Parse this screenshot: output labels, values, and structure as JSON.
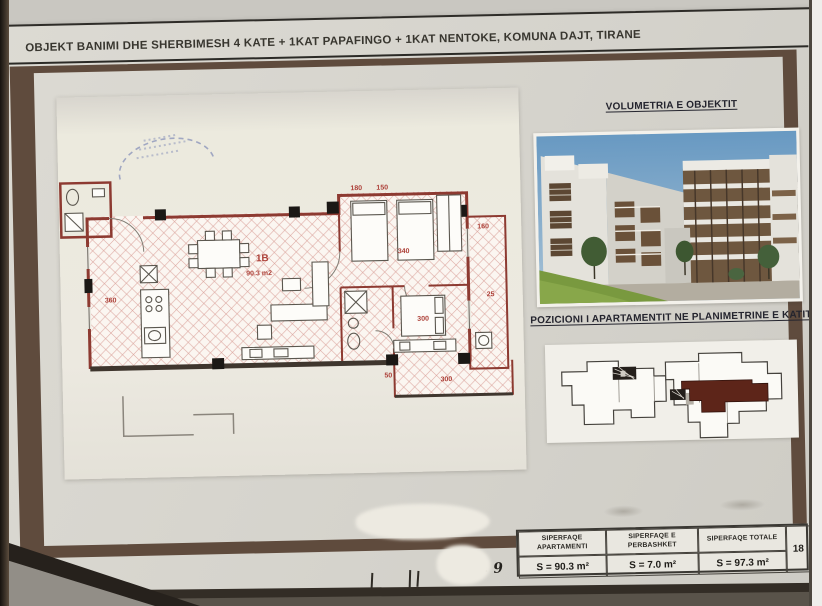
{
  "sheet": {
    "title": "OBJEKT BANIMI DHE SHERBIMESH 4 KATE + 1KAT PAPAFINGO + 1KAT NENTOKE, KOMUNA DAJT, TIRANE"
  },
  "volumetria": {
    "heading": "VOLUMETRIA E OBJEKTIT"
  },
  "pozicioni": {
    "heading": "POZICIONI I APARTAMENTIT NE PLANIMETRINE E KATIT"
  },
  "floor_plan": {
    "unit_label": "1B",
    "unit_area": "90.3 m2",
    "dimensions": [
      "360",
      "180",
      "150",
      "340",
      "160",
      "25",
      "300",
      "50",
      "300"
    ]
  },
  "summary_table": {
    "columns": [
      {
        "header": "SIPERFAQE APARTAMENTI",
        "value": "S = 90.3 m²"
      },
      {
        "header": "SIPERFAQE E PERBASHKET",
        "value": "S = 7.0 m²"
      },
      {
        "header": "SIPERFAQE TOTALE",
        "value": "S = 97.3 m²"
      }
    ],
    "sheet_number": "18"
  },
  "footer": {
    "signature_label": "Z/ZNJ",
    "handwritten_note": "= 9"
  },
  "colors": {
    "wall_red": "#8d3a31",
    "frame_brown": "#5f4b3d",
    "highlight_maroon": "#5d2519",
    "sky_blue": "#6899c2",
    "grass_green": "#79993f"
  }
}
